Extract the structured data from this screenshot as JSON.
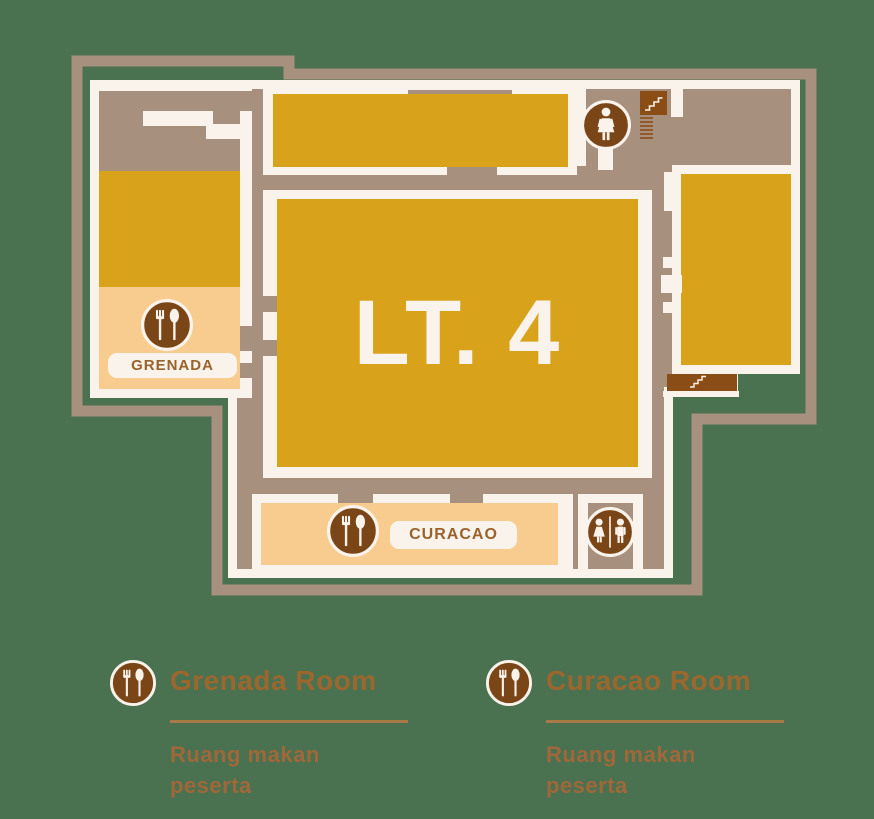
{
  "colors": {
    "background": "#4a7150",
    "wall_tan": "#a8907e",
    "wall_cream": "#faf3eb",
    "room_gold": "#d9a21b",
    "room_peach": "#f8cc8e",
    "icon_brown": "#7b4617",
    "stairs_brown": "#8a4d15",
    "room_label_text": "#99622c",
    "legend_title_text": "#9c672f",
    "legend_subtitle_text": "#a0683a"
  },
  "floor_plan": {
    "title": "LT. 4",
    "grenada": {
      "label": "GRENADA",
      "icon": "fork-spoon-icon"
    },
    "curacao": {
      "label": "CURACAO",
      "icon": "fork-spoon-icon"
    },
    "icons": {
      "women_restroom": "woman-restroom-icon",
      "unisex_restroom": "unisex-restroom-icon",
      "stairs_top": "stairs-icon",
      "stairs_bottom": "stairs-icon"
    }
  },
  "legend": {
    "items": [
      {
        "icon": "fork-spoon-icon",
        "title": "Grenada Room",
        "subtitle_lines": [
          "Ruang makan",
          "peserta"
        ]
      },
      {
        "icon": "fork-spoon-icon",
        "title": "Curacao Room",
        "subtitle_lines": [
          "Ruang makan",
          "peserta"
        ]
      }
    ]
  }
}
